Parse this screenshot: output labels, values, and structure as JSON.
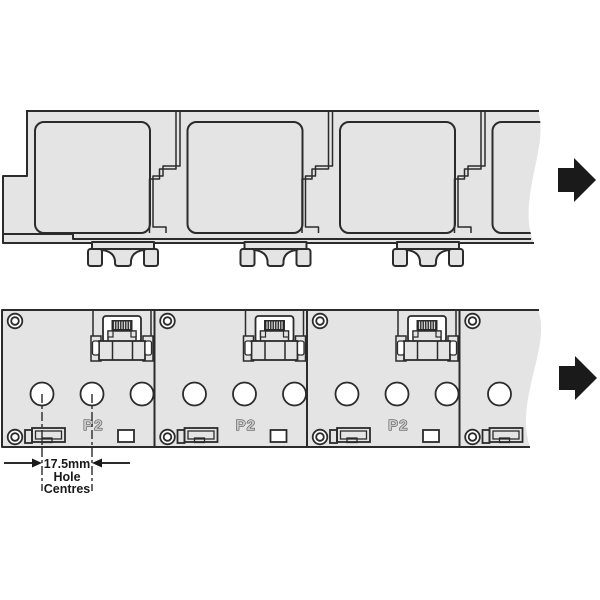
{
  "colors": {
    "background": "#ffffff",
    "body": "#e4e4e4",
    "line": "#2b2b2b",
    "arrow": "#1a1a1a",
    "dimension_text": "#1a1a1a",
    "port_label_fill": "#c9c9c9",
    "pins": "#2a2a2a",
    "hole": "#ffffff"
  },
  "front_view": {
    "modules": [
      {
        "port_label": "P2"
      },
      {
        "port_label": "P2"
      },
      {
        "port_label": "P2"
      }
    ]
  },
  "dimension_callout": {
    "value": "17.5mm",
    "label_line_2": "Hole",
    "label_line_3": "Centres"
  }
}
